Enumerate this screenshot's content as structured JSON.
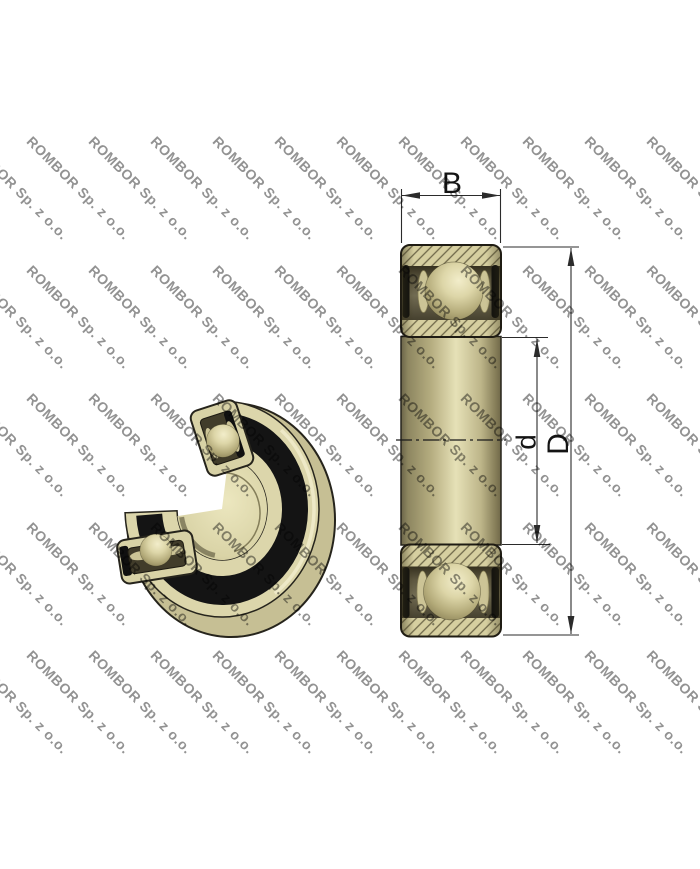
{
  "watermark": {
    "text": "ROMBOR Sp. z o.o."
  },
  "dimensions": {
    "width_label": "B",
    "bore_diameter_label": "d",
    "outer_diameter_label": "D"
  },
  "colors": {
    "background": "#ffffff",
    "watermark-gray": "#8d8d8d",
    "metal-tan": "#d6cfa0",
    "metal-tan-light": "#e6e1b7",
    "seal-black": "#111111",
    "outline-dark": "#26241c",
    "recess-dark": "#514b36",
    "dim-line": "#2b2b2b"
  }
}
